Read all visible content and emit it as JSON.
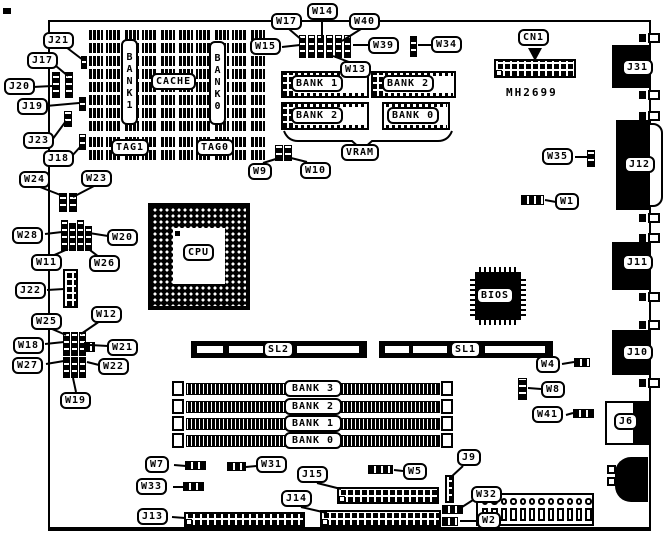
{
  "board": {
    "part_number": "MH2699"
  },
  "chips": {
    "cpu": "CPU",
    "bios": "BIOS",
    "cache": "CACHE",
    "cache_bank1": "BANK1",
    "cache_bank0": "BANK0",
    "tag1": "TAG1",
    "tag0": "TAG0"
  },
  "vram": {
    "caption": "VRAM",
    "bank1": "BANK 1",
    "bank2_top": "BANK 2",
    "bank2_bottom": "BANK 2",
    "bank0": "BANK 0"
  },
  "memory_banks": {
    "bank3": "BANK 3",
    "bank2": "BANK 2",
    "bank1": "BANK 1",
    "bank0": "BANK 0"
  },
  "slots": {
    "sl2": "SL2",
    "sl1": "SL1"
  },
  "connectors": {
    "cn1": "CN1",
    "j6": "J6",
    "j9": "J9",
    "j10": "J10",
    "j11": "J11",
    "j12": "J12",
    "j13": "J13",
    "j14": "J14",
    "j15": "J15",
    "j17": "J17",
    "j18": "J18",
    "j19": "J19",
    "j20": "J20",
    "j21": "J21",
    "j22": "J22",
    "j23": "J23",
    "j31": "J31"
  },
  "jumpers": {
    "w1": "W1",
    "w2": "W2",
    "w4": "W4",
    "w5": "W5",
    "w7": "W7",
    "w8": "W8",
    "w9": "W9",
    "w10": "W10",
    "w11": "W11",
    "w12": "W12",
    "w13": "W13",
    "w14": "W14",
    "w15": "W15",
    "w17": "W17",
    "w18": "W18",
    "w19": "W19",
    "w20": "W20",
    "w21": "W21",
    "w22": "W22",
    "w23": "W23",
    "w24": "W24",
    "w25": "W25",
    "w26": "W26",
    "w27": "W27",
    "w28": "W28",
    "w31": "W31",
    "w32": "W32",
    "w33": "W33",
    "w34": "W34",
    "w35": "W35",
    "w39": "W39",
    "w40": "W40",
    "w41": "W41"
  }
}
